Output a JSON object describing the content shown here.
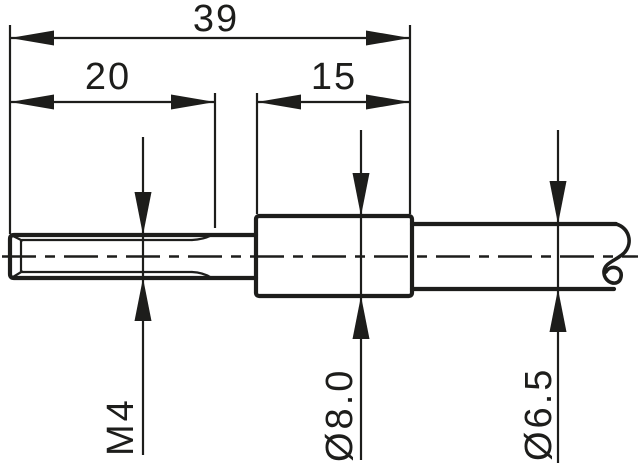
{
  "drawing": {
    "type": "technical-dimension-drawing",
    "background_color": "#ffffff",
    "line_color": "#1d1d1b",
    "dimensions": {
      "overall_length": {
        "label": "39"
      },
      "thread_length": {
        "label": "20"
      },
      "body_length": {
        "label": "15"
      },
      "thread_size": {
        "label": "M4"
      },
      "body_diameter": {
        "label": "Ø8.0"
      },
      "cable_diameter": {
        "label": "Ø6.5"
      }
    }
  }
}
